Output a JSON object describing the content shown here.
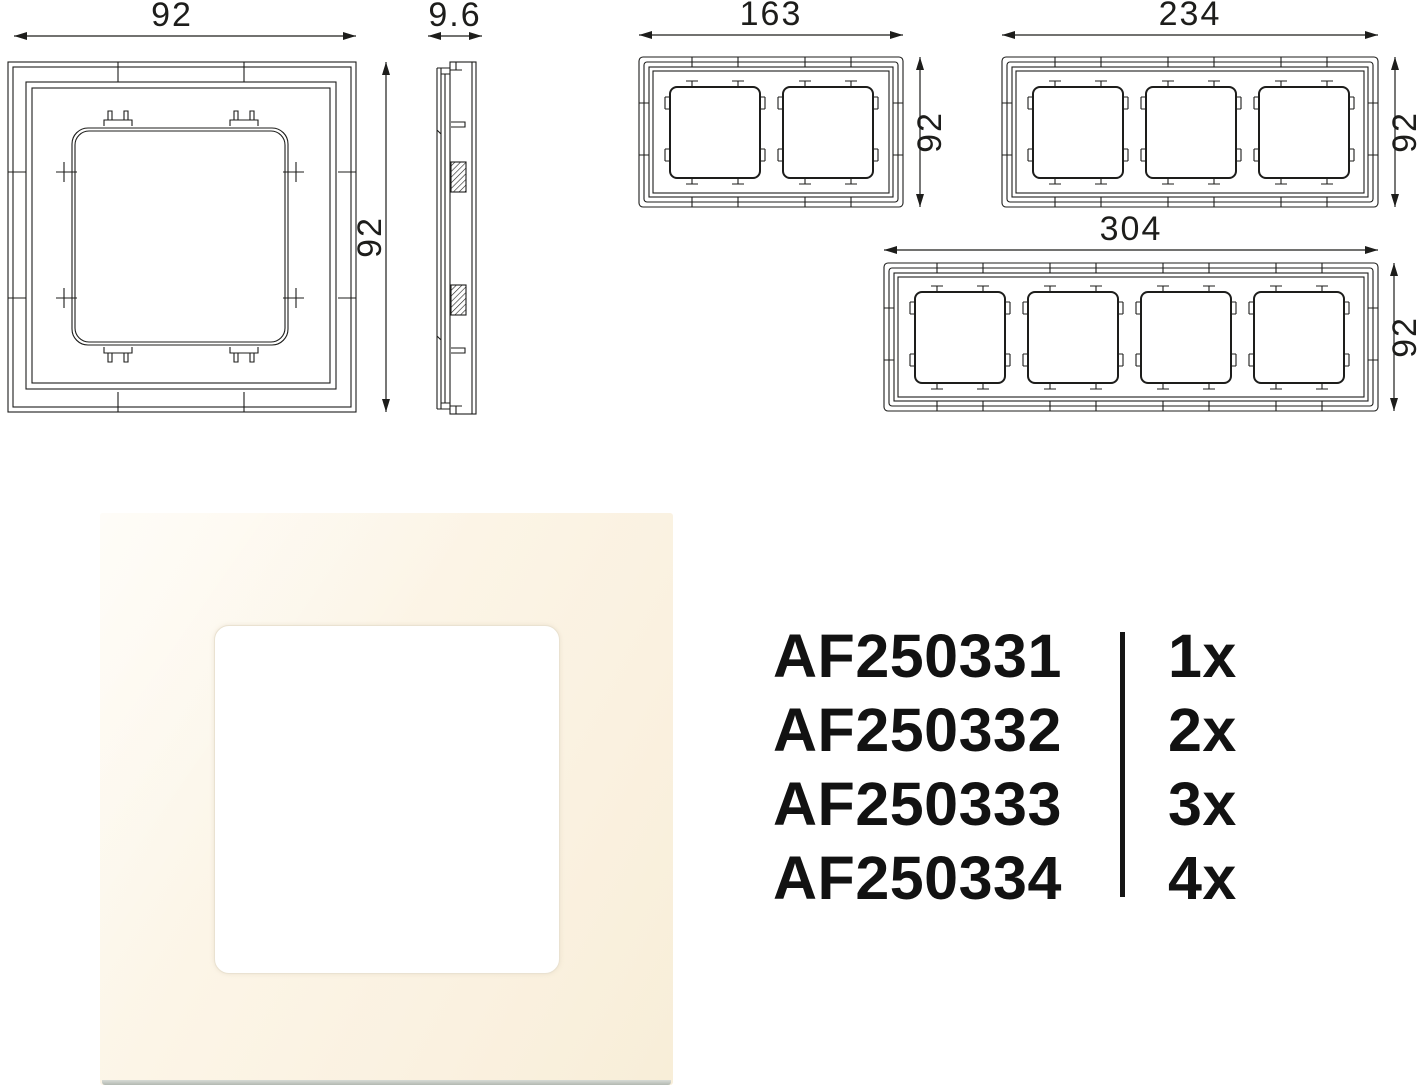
{
  "colors": {
    "drawing_line": "#1d1d1b",
    "text": "#121212",
    "photo_frame_light": "#fdf9ef",
    "photo_frame_dark": "#f8eed8",
    "photo_opening": "#ffffff",
    "photo_bottom_edge": "#b2b8b1"
  },
  "dimensions": {
    "front": {
      "width": "92",
      "height": "92"
    },
    "side": {
      "depth": "9.6"
    },
    "gang2": {
      "width": "163",
      "height": "92"
    },
    "gang3": {
      "width": "234",
      "height": "92"
    },
    "gang4": {
      "width": "304",
      "height": "92"
    }
  },
  "products": {
    "rows": [
      {
        "code": "AF250331",
        "qty": "1x"
      },
      {
        "code": "AF250332",
        "qty": "2x"
      },
      {
        "code": "AF250333",
        "qty": "3x"
      },
      {
        "code": "AF250334",
        "qty": "4x"
      }
    ]
  }
}
